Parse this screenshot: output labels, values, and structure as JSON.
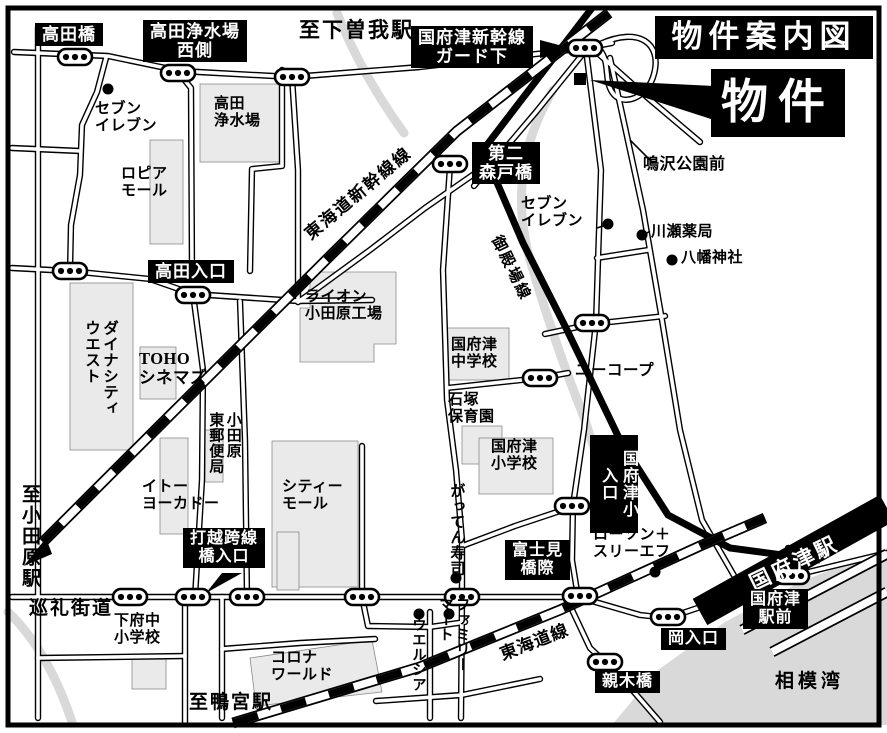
{
  "map": {
    "title": "物件案内図",
    "property_label": "物件",
    "colors": {
      "ink": "#000000",
      "paper": "#ffffff",
      "building_fill": "#eaeaea",
      "water_gray": "#d9d9d9"
    },
    "boxes": {
      "takadabashi": "高田橋",
      "takada_josuijo_nishigawa": "高田浄水場\n西側",
      "kozu_shinkansen_gado_shita": "国府津新幹線\nガード下",
      "daini_moritobashi": "第二\n森戸橋",
      "takada_iriguchi": "高田入口",
      "kozusho_iriguchi": "国府津小\n入口",
      "uchikoshi_kosenkyo_iriguchi": "打越跨線\n橋入口",
      "fujimibashi_giwa": "富士見\n橋際",
      "kozu_ekimae": "国府津\n駅前",
      "oka_iriguchi": "岡入口",
      "oyagibashi": "親木橋"
    },
    "directions": {
      "shimosoga": "至下曽我駅",
      "odawara": "至小田原駅",
      "kamonomiya": "至鴨宮駅"
    },
    "railways": {
      "shinkansen": "東海道新幹線線",
      "gotemba": "御殿場線",
      "tokaido": "東海道線",
      "kozu_station": "国府津駅"
    },
    "roads": {
      "junrei_kaido": "巡礼街道"
    },
    "places": {
      "seven_eleven_1": "セブン\nイレブン",
      "seven_eleven_2": "セブン\nイレブン",
      "takada_josuijo": "高田\n浄水場",
      "lopia_mall": "ロピア\nモール",
      "narusawa_koen_mae": "鳴沢公園前",
      "kawase_yakkyoku": "川瀬薬局",
      "hachiman_jinja": "八幡神社",
      "dynacity_west": "ダイナシティ\nウエスト",
      "toho_cinemas": "TOHO\nシネマズ",
      "lion_odawara_kojo": "ライオン\n小田原工場",
      "kozu_chugakko": "国府津\n中学校",
      "ucoop": "ユーコープ",
      "ishizuka_hoikuen": "石塚\n保育園",
      "kozu_shogakko": "国府津\n小学校",
      "odawara_higashi_yubinkyoku": "小田原\n東郵便局",
      "ito_yokado": "イトー\nヨーカドー",
      "city_mall": "シティー\nモール",
      "gatten_zushi": "がってん寿司",
      "shimofuchu_shogakko": "下府中\n小学校",
      "lawson_three_f": "ローソン＋\nスリーエフ",
      "corona_world": "コロナ\nワールド",
      "welcia": "ウエルシア",
      "family_mart": "ファミリー\nマート"
    },
    "sea": "相模湾"
  }
}
